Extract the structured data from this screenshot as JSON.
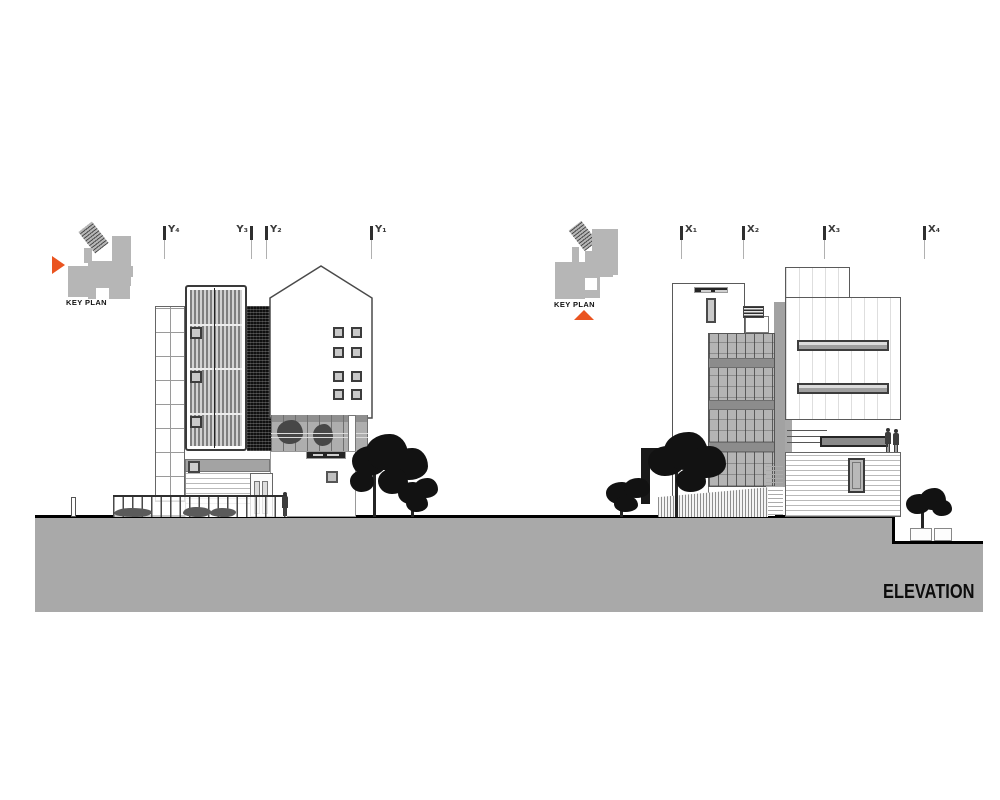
{
  "title_block": {
    "label": "ELEVATION"
  },
  "key_plans": {
    "left": {
      "label": "KEY PLAN",
      "arrow": "triangle-right"
    },
    "right": {
      "label": "KEY PLAN",
      "arrow": "triangle-up"
    }
  },
  "grid_markers": {
    "y": [
      {
        "label": "Y₄"
      },
      {
        "label": "Y₃"
      },
      {
        "label": "Y₂"
      },
      {
        "label": "Y₁"
      }
    ],
    "x": [
      {
        "label": "X₁"
      },
      {
        "label": "X₂"
      },
      {
        "label": "X₃"
      },
      {
        "label": "X₄"
      }
    ]
  },
  "drawing": {
    "type": "architectural elevation",
    "views": [
      "Y-axis elevation (left)",
      "X-axis elevation (right)"
    ]
  },
  "colors": {
    "accent_orange": "#ea5420",
    "ground_gray": "#a9a9a9",
    "ink": "#1a1a1a",
    "facade_gray": "#b4b4b4"
  }
}
